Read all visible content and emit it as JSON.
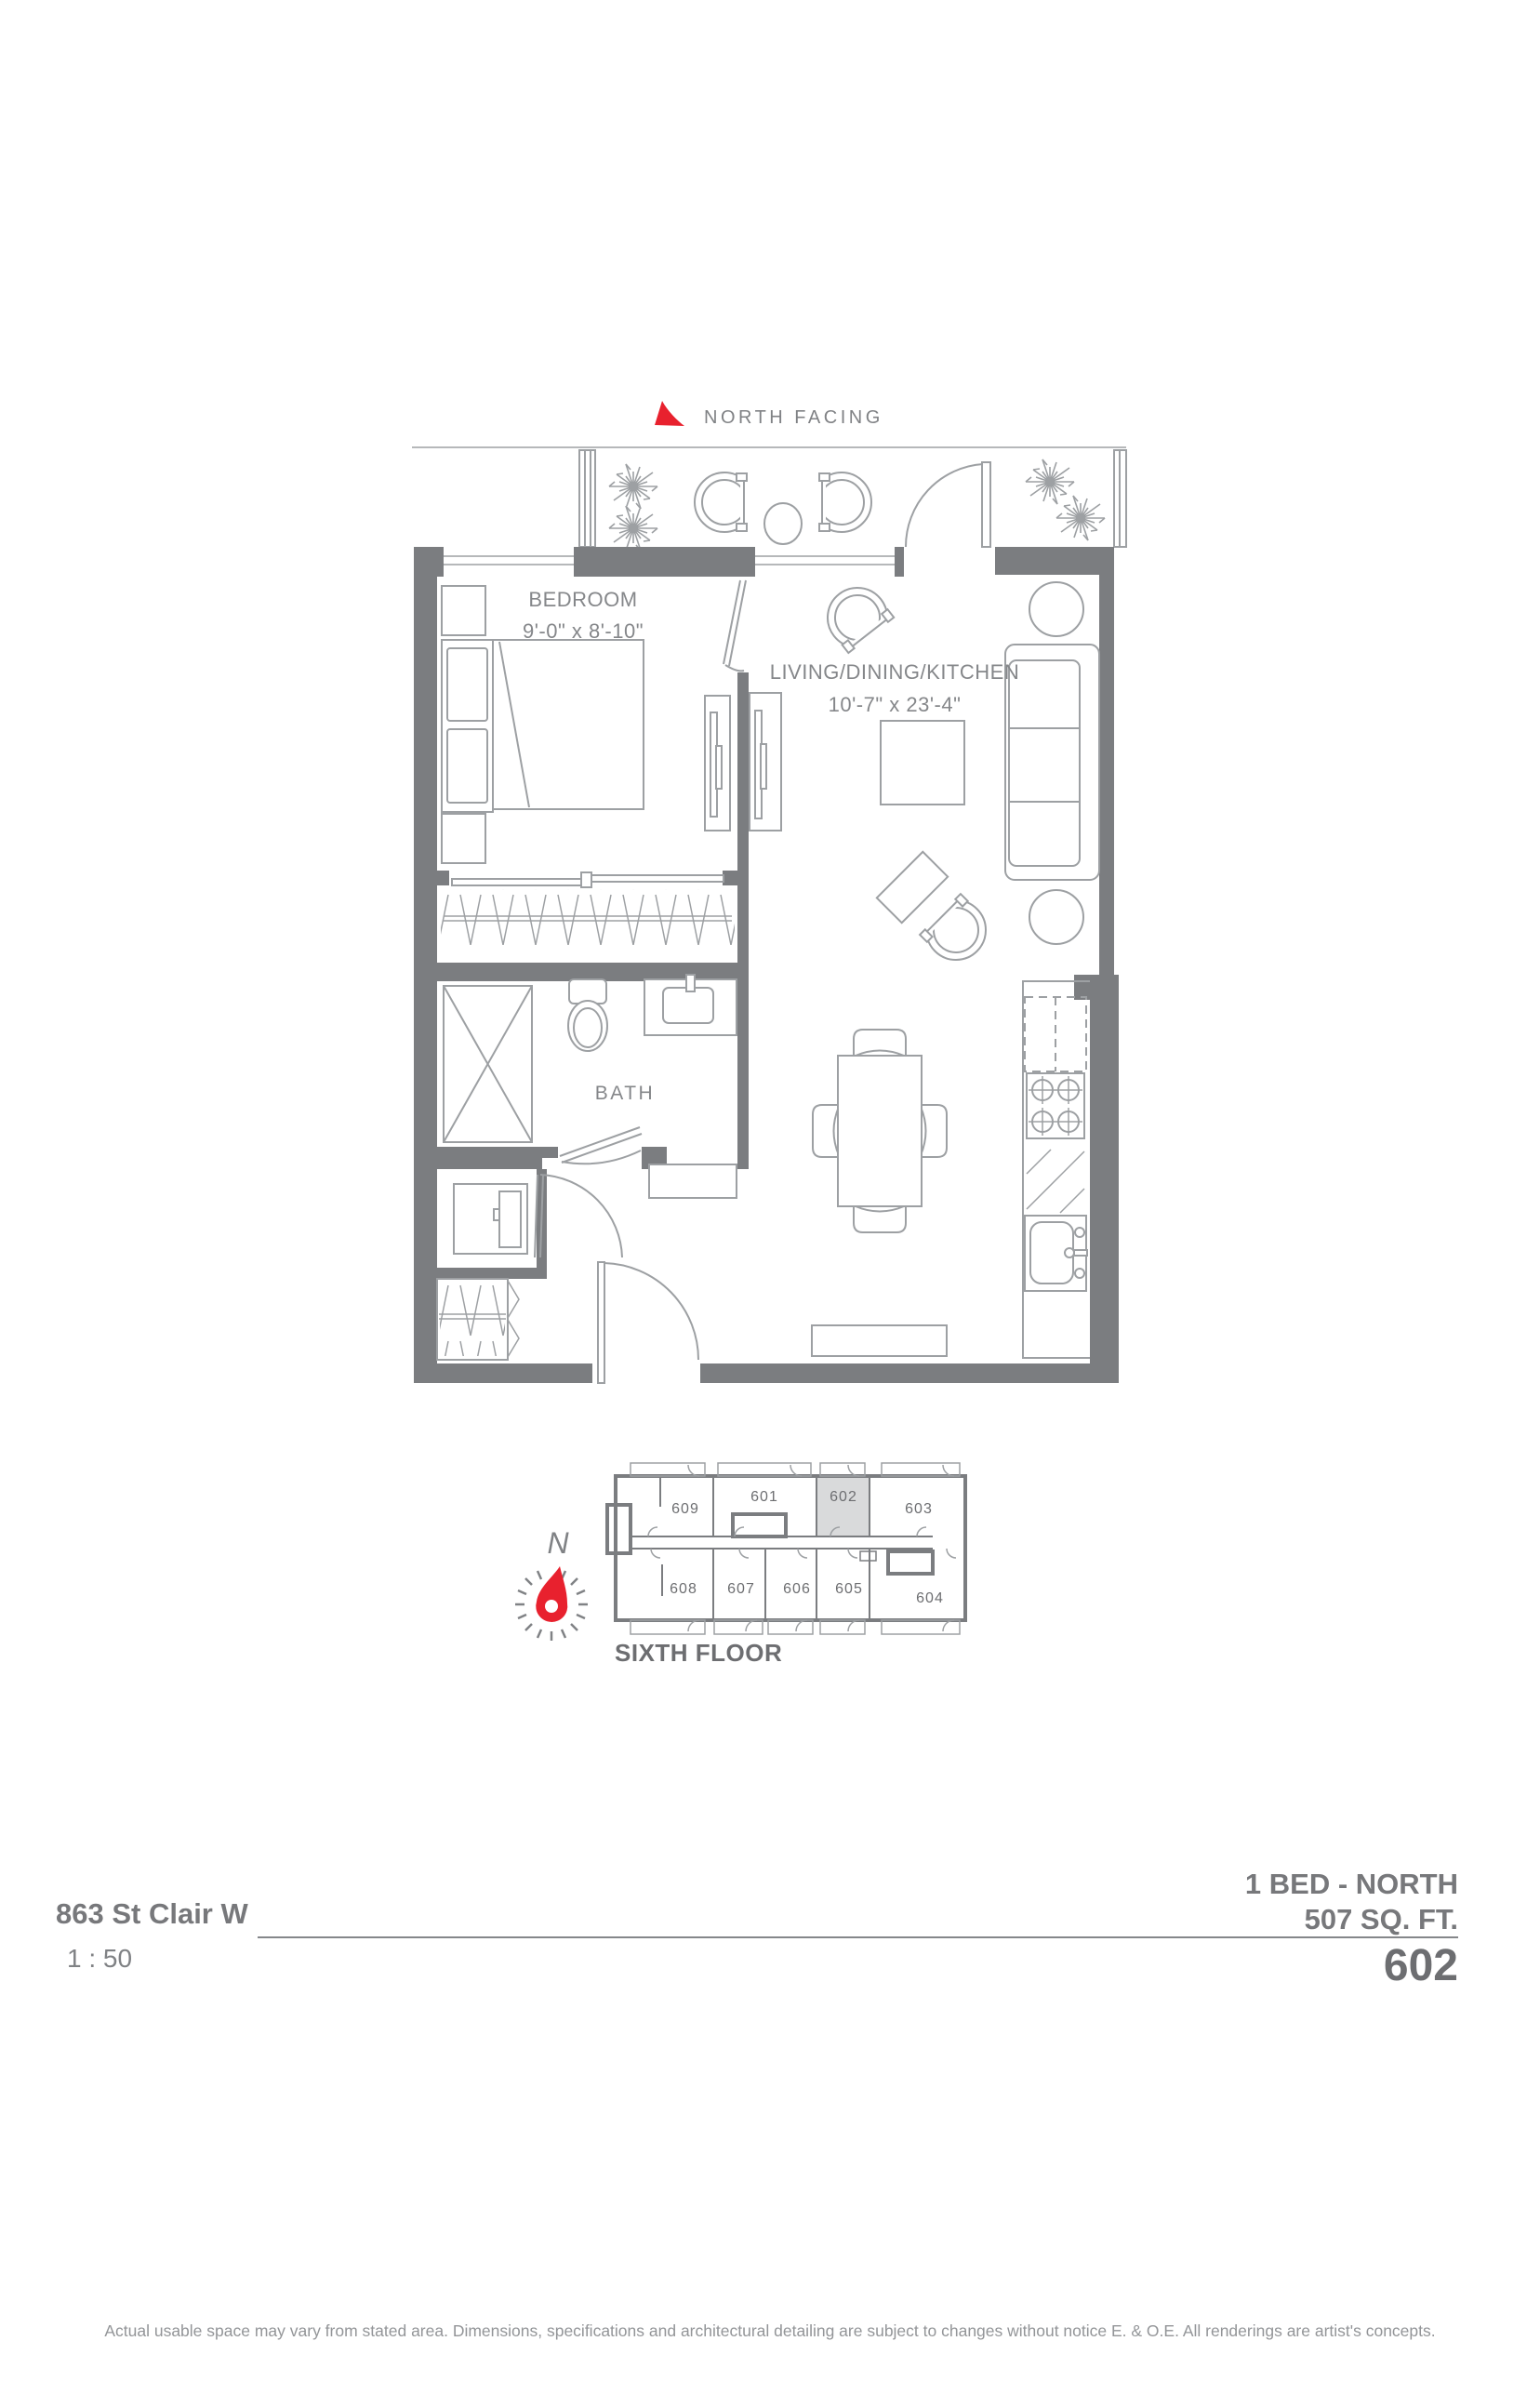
{
  "plan": {
    "north_facing": "NORTH FACING",
    "balcony": {
      "label": "BALCONY",
      "area": "46 ft²"
    },
    "bedroom": {
      "label": "BEDROOM",
      "dims": "9'-0\" x 8'-10\""
    },
    "living": {
      "label": "LIVING/DINING/KITCHEN",
      "dims": "10'-7\" x 23'-4\""
    },
    "bath": {
      "label": "BATH"
    }
  },
  "keyplan": {
    "floor": "SIXTH FLOOR",
    "compass": "N",
    "highlighted_unit": "602",
    "units": {
      "601": "601",
      "602": "602",
      "603": "603",
      "604": "604",
      "605": "605",
      "606": "606",
      "607": "607",
      "608": "608",
      "609": "609"
    }
  },
  "titleblock": {
    "address": "863 St Clair W",
    "scale": "1 : 50",
    "plan_name": "1 BED - NORTH",
    "area": "507 SQ. FT.",
    "unit": "602"
  },
  "footer": "Actual usable space may vary from stated area. Dimensions, specifications and architectural detailing are subject to changes without notice E. & O.E. All renderings are artist's concepts.",
  "colors": {
    "wall": "#7b7d80",
    "furniture_line": "#9da0a3",
    "text": "#808285",
    "dark_text": "#6d6e71",
    "accent_red": "#e8212e",
    "unit_highlight": "#d9dadb"
  }
}
